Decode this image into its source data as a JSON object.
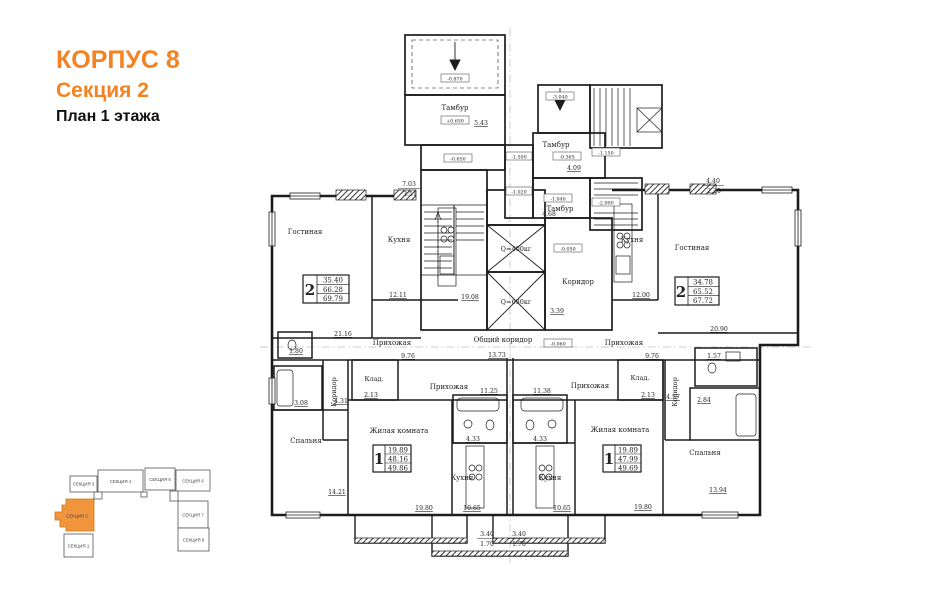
{
  "header": {
    "building": "КОРПУС 8",
    "section": "Секция 2",
    "floor": "План 1 этажа"
  },
  "colors": {
    "accent": "#f58220",
    "minimap_active_fill": "#f0953c",
    "ink": "#232323"
  },
  "stamps": {
    "apt2_left": {
      "rooms": "2",
      "living": "35.40",
      "area": "66.28",
      "total": "69.79"
    },
    "apt2_right": {
      "rooms": "2",
      "living": "34.78",
      "area": "65.52",
      "total": "67.72"
    },
    "apt1_left": {
      "rooms": "1",
      "living": "19.89",
      "area": "48.16",
      "total": "49.86"
    },
    "apt1_right": {
      "rooms": "1",
      "living": "19.89",
      "area": "47.99",
      "total": "49.69"
    }
  },
  "labels": {
    "tambour_left": "Тамбур",
    "tambour_right_1": "Тамбур",
    "tambour_right_2": "Тамбур",
    "corridor_core": "Коридор",
    "common_corridor": "Общий коридор",
    "elevator_1": "Q=400кг",
    "elevator_2": "Q=630кг",
    "living_room_left": "Гостиная",
    "kitchen_left": "Кухня",
    "hallway_left": "Прихожая",
    "corridor_left": "Коридор",
    "bedroom_left": "Спальня",
    "storage_left": "Клад.",
    "room_left": "Жилая комната",
    "kitchen_1l": "Кухня",
    "hallway_1l": "Прихожая",
    "living_room_right": "Гостиная",
    "kitchen_right": "Кухня",
    "hallway_right": "Прихожая",
    "corridor_right": "Коридор",
    "bedroom_right": "Спальня",
    "storage_right": "Клад.",
    "room_right": "Жилая комната",
    "kitchen_1r": "Кухня",
    "hallway_1r": "Прихожая"
  },
  "areas": {
    "tambour_left": "5.43",
    "tambour_r1": "4.09",
    "tambour_r2": "4.68",
    "corridor_core": "3.39",
    "stairwell": "19.08",
    "common_corridor": "13.73",
    "loggia_l_full": "7.03",
    "loggia_l_half": "3.51",
    "loggia_r_full": "4.40",
    "loggia_r_half": "2.20",
    "living_l": "21.16",
    "kitchen_l": "12.11",
    "hall_l": "9.76",
    "bath_l": "3.08",
    "corr_l": "4.31",
    "wc_l": "1.80",
    "bedroom_l": "14.21",
    "living_r": "20.90",
    "kitchen_r": "12.00",
    "hall_r": "9.76",
    "bath_r": "2.84",
    "corr_r": "4.57",
    "wc_r": "1.57",
    "bedroom_r": "13.94",
    "storage_1l": "2.13",
    "hall_1l": "11.25",
    "bath_1l": "4.33",
    "kitchen_1l": "10.65",
    "room_1l": "19.80",
    "storage_1r": "2.13",
    "hall_1r": "11.38",
    "bath_1r": "4.33",
    "kitchen_1r": "10.65",
    "room_1r": "19.80",
    "balcony_1l_full": "3.40",
    "balcony_1l_half": "1.70",
    "balcony_1r_full": "3.40",
    "balcony_1r_half": "1.70"
  },
  "elevations": {
    "porch_left": "-0.870",
    "tambour_left": "+0.650",
    "room_left": "-0.650",
    "porch_right": "-3.040",
    "tambour_r1": "-0.365",
    "stair_mid": "-1.150",
    "passage_up": "-1.500",
    "passage_low": "-1.020",
    "tambour_r2": "-1.040",
    "basement": "-2.000",
    "corridor": "-0.050",
    "common": "-0.060"
  },
  "minimap": {
    "sections": [
      {
        "label": "СЕКЦИЯ 1"
      },
      {
        "label": "СЕКЦИЯ 2"
      },
      {
        "label": "СЕКЦИЯ 3"
      },
      {
        "label": "СЕКЦИЯ 4"
      },
      {
        "label": "СЕКЦИЯ 5"
      },
      {
        "label": "СЕКЦИЯ 6"
      },
      {
        "label": "СЕКЦИЯ 7"
      },
      {
        "label": "СЕКЦИЯ 8"
      }
    ],
    "active": "СЕКЦИЯ 2"
  }
}
